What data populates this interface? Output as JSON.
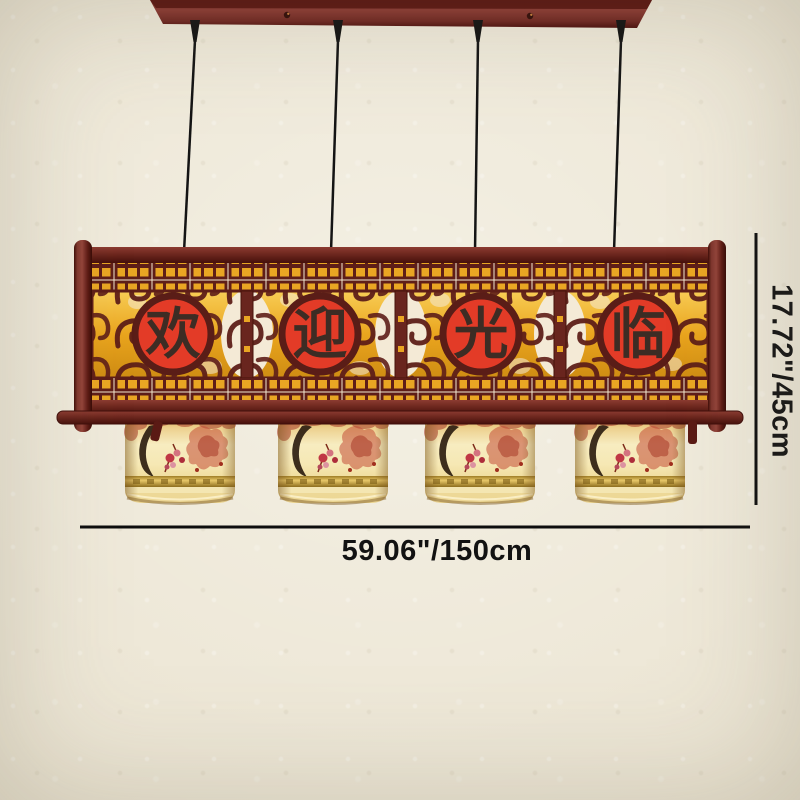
{
  "product": {
    "name": "chinese-wooden-welcome-pendant-lamp",
    "panel_phrase": "欢迎光临",
    "panel_characters": [
      {
        "char": "欢"
      },
      {
        "char": "迎"
      },
      {
        "char": "光"
      },
      {
        "char": "临"
      }
    ],
    "shade_count": 4,
    "cord_count": 4
  },
  "annotations": {
    "width_label": "59.06\"/150cm",
    "height_label": "17.72\"/45cm"
  },
  "colors": {
    "background": "#ebe4d2",
    "wood_dark": "#5e1e18",
    "wood_mid": "#8a3831",
    "panel_gold": "#e9a623",
    "medallion_red": "#e33b27",
    "character_ink": "#3d2c24",
    "openwork_cream": "#f4ead6",
    "shade_cream": "#f6e8b4",
    "shade_pattern_red": "#c24c36",
    "gold_band": "#e8c868",
    "dimension_line": "#0d0d0d",
    "cable_black": "#141414"
  }
}
